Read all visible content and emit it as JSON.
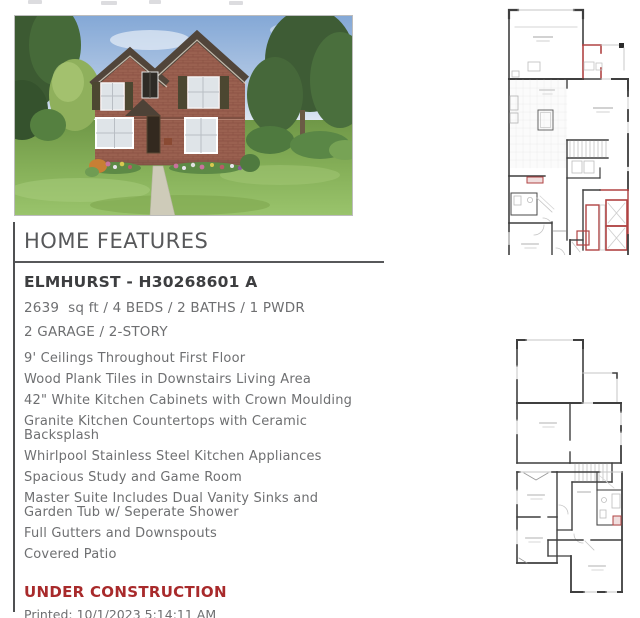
{
  "photo": {
    "name": "elmhurst-exterior-rendering"
  },
  "features_panel": {
    "section_title": "HOME FEATURES",
    "plan_name": "ELMHURST - H30268601 A",
    "specs": [
      "2639  sq ft / 4 BEDS / 2 BATHS / 1 PWDR",
      "2 GARAGE / 2-STORY"
    ],
    "features": [
      "9' Ceilings Throughout First Floor",
      "Wood Plank Tiles in Downstairs Living Area",
      "42\" White Kitchen Cabinets with Crown Moulding",
      "Granite Kitchen Countertops with Ceramic Backsplash",
      "Whirlpool Stainless Steel Kitchen Appliances",
      "Spacious Study and Game Room",
      "Master Suite Includes Dual Vanity Sinks and Garden Tub w/ Seperate Shower",
      "Full Gutters and Downspouts",
      "Covered Patio"
    ],
    "status": "UNDER CONSTRUCTION",
    "printed": "Printed: 10/1/2023 5:14:11 AM"
  },
  "floor_plans": {
    "first_floor": "first-floor-plan",
    "second_floor": "second-floor-plan"
  },
  "colors": {
    "heading_gray": "#57585a",
    "body_gray": "#6e6f71",
    "plan_name_dark": "#3d3e40",
    "status_red": "#a82a2b",
    "wall_dark": "#3f3f3f",
    "wall_light": "#c6c6c6",
    "wall_red": "#b04343"
  }
}
